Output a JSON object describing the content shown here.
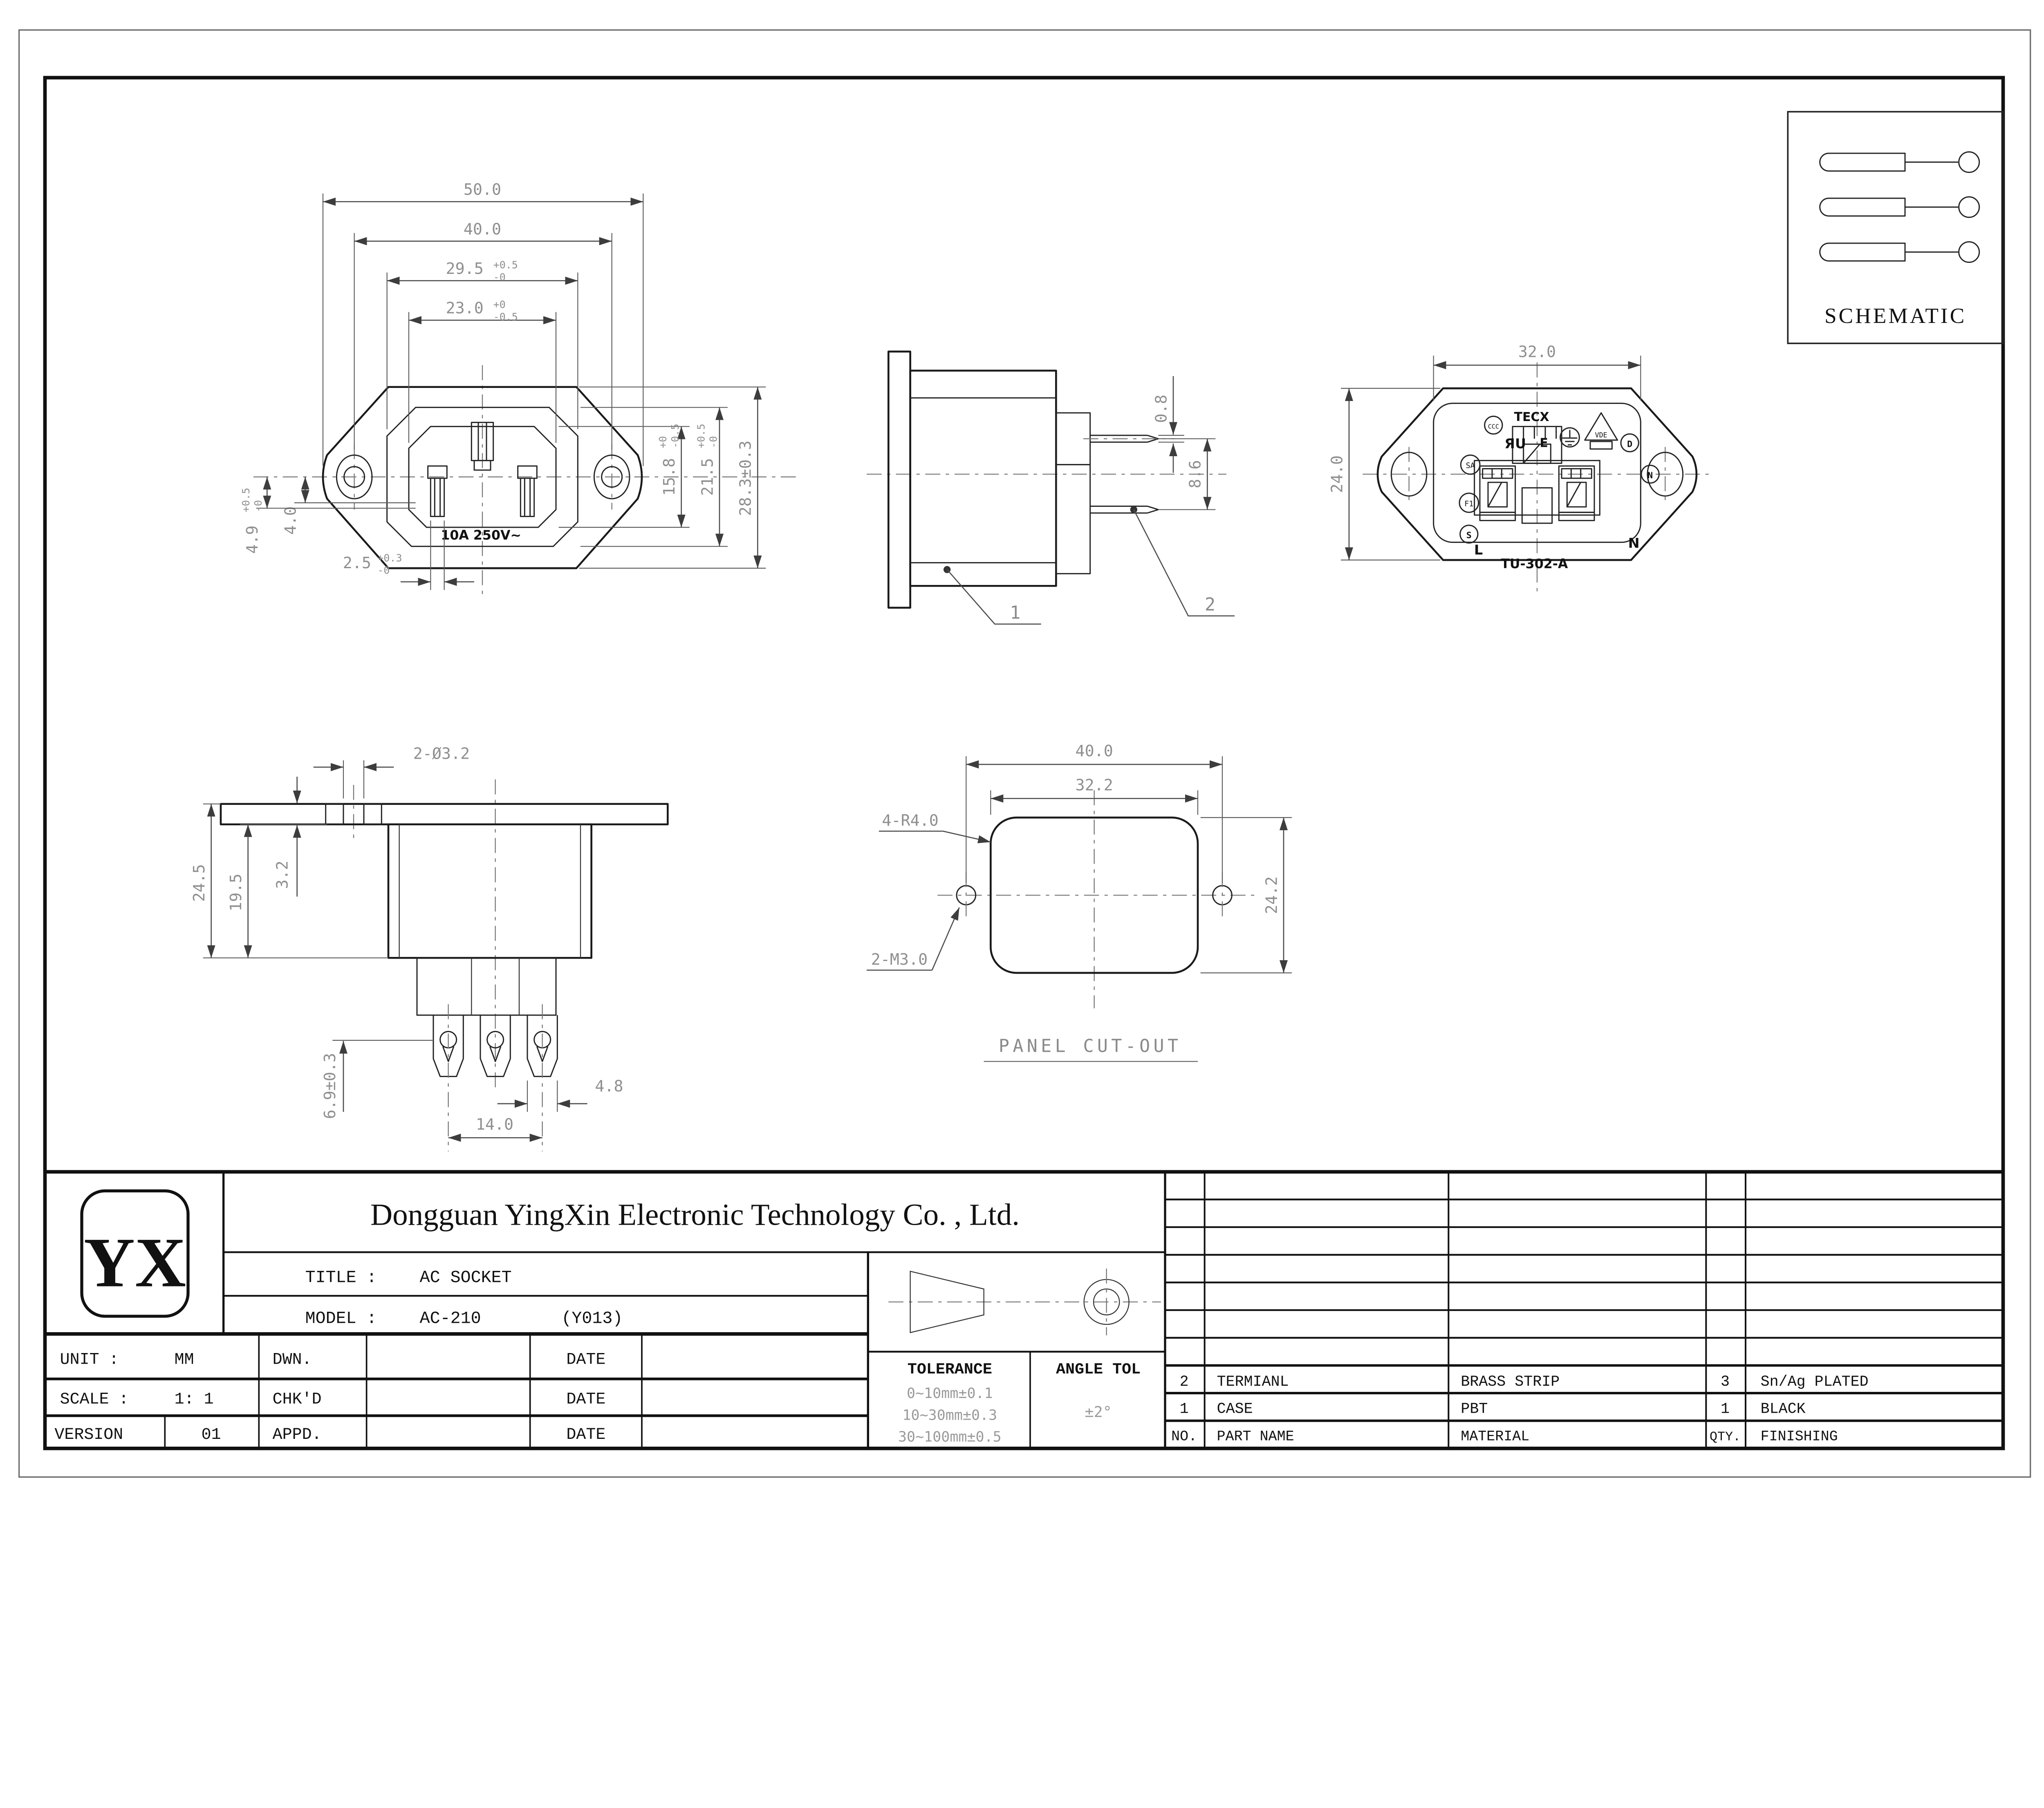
{
  "colors": {
    "paper": "#ffffff",
    "object_line": "#1a1a1a",
    "dimension": "#8f8f8f",
    "title_line": "#111111"
  },
  "drawing": {
    "schematic": {
      "label": "SCHEMATIC"
    },
    "front": {
      "d50": "50.0",
      "d40": "40.0",
      "d295": {
        "v": "29.5",
        "up": "+0.5",
        "dn": "-0"
      },
      "d230": {
        "v": "23.0",
        "up": "+0",
        "dn": "-0.5"
      },
      "d158": {
        "v": "15.8",
        "up": "+0",
        "dn": "-0.5"
      },
      "d215": {
        "v": "21.5",
        "up": "+0.5",
        "dn": "-0"
      },
      "d283": "28.3±0.3",
      "d4": "4.0",
      "d49": {
        "v": "4.9",
        "up": "+0.5",
        "dn": "-0"
      },
      "d25": {
        "v": "2.5",
        "up": "+0.3",
        "dn": "-0"
      },
      "rating": "10A 250V~"
    },
    "side": {
      "d08": "0.8",
      "d86": "8.6",
      "ref1": "1",
      "ref2": "2"
    },
    "back": {
      "d32": "32.0",
      "d24": "24.0",
      "marks": {
        "tecx": "TECX",
        "ccc": "CCC",
        "ul": "ЯU",
        "e": "E",
        "vde": "VDE",
        "d": "D",
        "sa": "SA",
        "n_badge": "N",
        "f1": "F1",
        "s": "S",
        "l": "L",
        "n": "N",
        "model": "TU-302-A"
      }
    },
    "mount": {
      "d2o32": "2-Ø3.2",
      "d245": "24.5",
      "d195": "19.5",
      "d32": "3.2",
      "d48": "4.8",
      "d140": "14.0",
      "d69": "6.9±0.3"
    },
    "panel": {
      "d400": "40.0",
      "d322": "32.2",
      "d242": "24.2",
      "r": "4-R4.0",
      "m": "2-M3.0",
      "label": "PANEL CUT-OUT"
    }
  },
  "title_block": {
    "logo": "YX",
    "company": "Dongguan YingXin Electronic Technology Co. , Ltd.",
    "title_label": "TITLE :",
    "title_value": "AC SOCKET",
    "model_label": "MODEL :",
    "model_value": "AC-210",
    "model_note": "(Y013)",
    "unit_label": "UNIT  :",
    "unit_value": "MM",
    "scale_label": "SCALE :",
    "scale_value": "1: 1",
    "version_label": "VERSION",
    "version_value": "01",
    "dwn_label": "DWN.",
    "chkd_label": "CHK'D",
    "appd_label": "APPD.",
    "date1": "DATE",
    "date2": "DATE",
    "date3": "DATE",
    "tolerance": {
      "label": "TOLERANCE",
      "rows": [
        "0~10mm±0.1",
        "10~30mm±0.3",
        "30~100mm±0.5"
      ],
      "angle_label": "ANGLE TOL",
      "angle_value": "±2°"
    },
    "parts": {
      "header": {
        "no": "NO.",
        "name": "PART  NAME",
        "material": "MATERIAL",
        "qty": "QTY.",
        "finish": "FINISHING"
      },
      "rows": [
        {
          "no": "2",
          "name": "TERMIANL",
          "material": "BRASS STRIP",
          "qty": "3",
          "finish": "Sn/Ag PLATED"
        },
        {
          "no": "1",
          "name": "CASE",
          "material": "PBT",
          "qty": "1",
          "finish": "BLACK"
        }
      ]
    }
  }
}
